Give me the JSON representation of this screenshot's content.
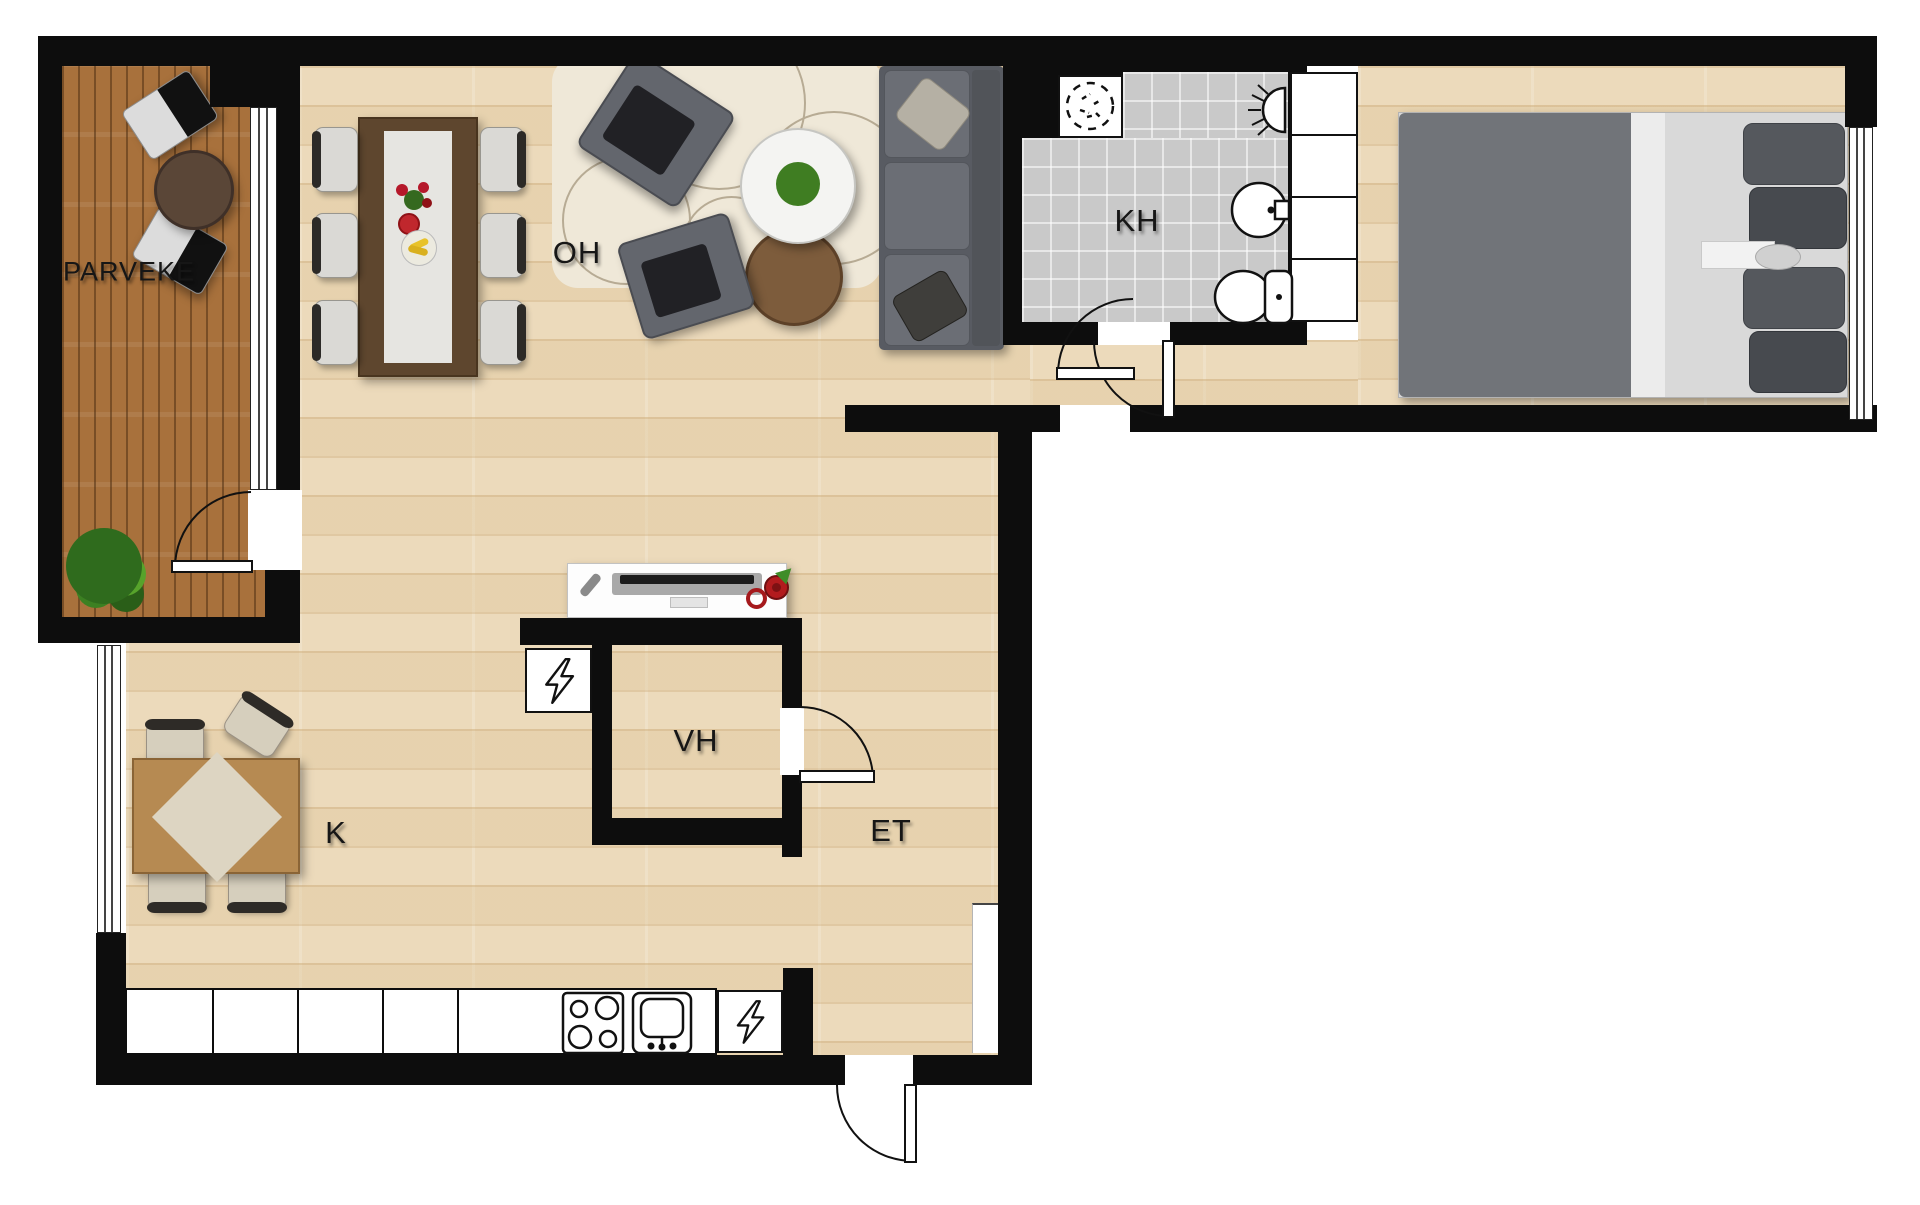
{
  "page": {
    "type": "apartment-floor-plan"
  },
  "rooms": {
    "balcony": {
      "label": "PARVEKE"
    },
    "living_room": {
      "label": "OH"
    },
    "bathroom": {
      "label": "KH"
    },
    "closet": {
      "label": "VH"
    },
    "entry_hall": {
      "label": "ET"
    },
    "kitchen": {
      "label": "K"
    }
  },
  "icons": {
    "washing_machine_reservation": "dashed-circle",
    "electrical_panel": "lightning-bolt",
    "bathroom_light": "semicircle-with-rays",
    "stove": "four-burner-circles",
    "kitchen_sink": "basin-with-faucet",
    "toilet": "bowl-and-tank",
    "washbasin": "round-basin"
  },
  "colors": {
    "wall": "#0d0d0d",
    "wood_floor": "#ecdabb",
    "balcony_deck": "#a8713c",
    "bathroom_tile": "#c9c9c9",
    "sofa_gray": "#6b6e75",
    "bed_blanket": "#717479",
    "dining_table_brown": "#5e462e",
    "accent_red": "#b21b1e",
    "plant_green": "#3f7d22",
    "rug_cream": "#efe8d8"
  }
}
